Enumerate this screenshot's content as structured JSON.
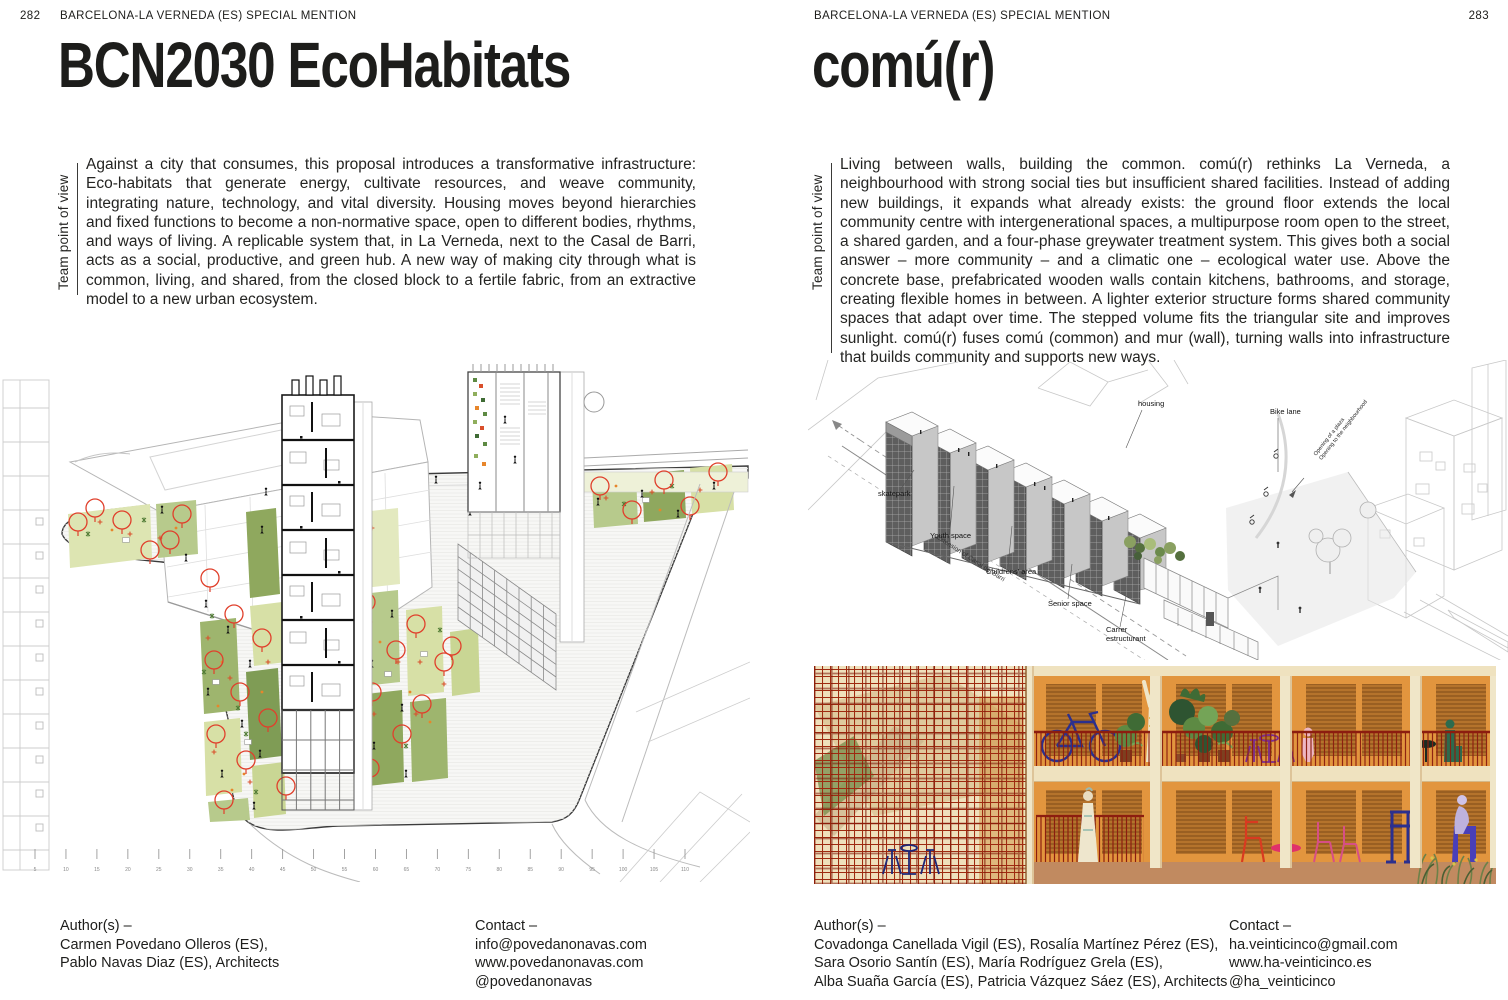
{
  "colors": {
    "tree_red": "#e0402c",
    "plan_green_light": "#d7e0a6",
    "plan_green_dark": "#7f9c55",
    "render_orange": "#e2953e",
    "render_shutter": "#b5732c",
    "render_cream": "#f0e2c0",
    "render_lattice_red": "#9e2a10",
    "render_rail_red": "#8c1d0f"
  },
  "left_page": {
    "page_number": "282",
    "header": "BARCELONA-LA VERNEDA (ES) SPECIAL MENTION",
    "title": "BCN2030 EcoHabitats",
    "sidebar_label": "Team point of view",
    "body": "Against a city that consumes, this proposal introduces a transformative infrastructure: Eco-habitats that generate energy, cultivate resources, and weave community, integrating nature, technology, and vital diversity. Housing moves beyond hierarchies and fixed functions to become a non-normative space, open to different bodies, rhythms, and ways of living. A replicable system that, in La Verneda, next to the Casal de Barri, acts as a social, productive, and green hub. A new way of making city through what is common, living, and shared, from the closed block to a fertile fabric, from an extractive model to a new urban ecosystem.",
    "illustration": {
      "description": "Axonometric site plan with garden plots, red tree circles and sectioned housing tower",
      "scale_ticks": [
        5,
        10,
        15,
        20,
        25,
        30,
        35,
        40,
        45,
        50,
        55,
        60,
        65,
        70,
        75,
        80,
        85,
        90,
        95,
        100,
        105,
        110
      ]
    },
    "footer": {
      "authors_label": "Author(s) –",
      "authors": [
        "Carmen Povedano Olleros (ES),",
        "Pablo Navas Diaz (ES), Architects"
      ],
      "contact_label": "Contact –",
      "contact": [
        "info@povedanonavas.com",
        "www.povedanonavas.com",
        "@povedanonavas"
      ]
    }
  },
  "right_page": {
    "page_number": "283",
    "header": "BARCELONA-LA VERNEDA (ES) SPECIAL MENTION",
    "title": "comú(r)",
    "sidebar_label": "Team point of view",
    "body": "Living between walls, building the common. comú(r) rethinks La Verneda, a neighbourhood with strong social ties but insufficient shared facilities. Instead of adding new buildings, it expands what already exists: the ground floor extends the local community centre with intergenerational spaces, a multipurpose room open to the street, a shared garden, and a four-phase greywater treatment system. This gives both a social answer – more community – and a climatic one – ecological water use. Above the concrete base, prefabricated wooden walls contain kitchens, bathrooms, and storage, creating flexible homes in between. A lighter exterior structure forms shared community spaces that adapt over time. The stepped volume fits the triangular site and improves sunlight. comú(r) fuses comú (common) and mur (wall), turning walls into infrastructure that builds community and supports new ways.",
    "axon": {
      "skatepark": "skatepark",
      "youth_space": "Youth space",
      "childrens_area": "Childrens' area",
      "senior_space": "Senior space",
      "carrer_line1": "Carrer",
      "carrer_line2": "estructurant",
      "housing": "housing",
      "bike_lane": "Bike lane",
      "street": "Extension of Casal del Barri",
      "note_line1": "Opening of a plaza",
      "note_line2": "Opening to the neighbourhood"
    },
    "footer": {
      "authors_label": "Author(s) –",
      "authors": [
        "Covadonga Canellada Vigil (ES), Rosalía Martínez Pérez (ES),",
        "Sara Osorio Santín (ES), María Rodríguez Grela (ES),",
        "Alba Suaña García (ES), Patricia Vázquez Sáez (ES), Architects"
      ],
      "contact_label": "Contact –",
      "contact": [
        "ha.veinticinco@gmail.com",
        "www.ha-veinticinco.es",
        "@ha_veinticinco"
      ]
    }
  }
}
